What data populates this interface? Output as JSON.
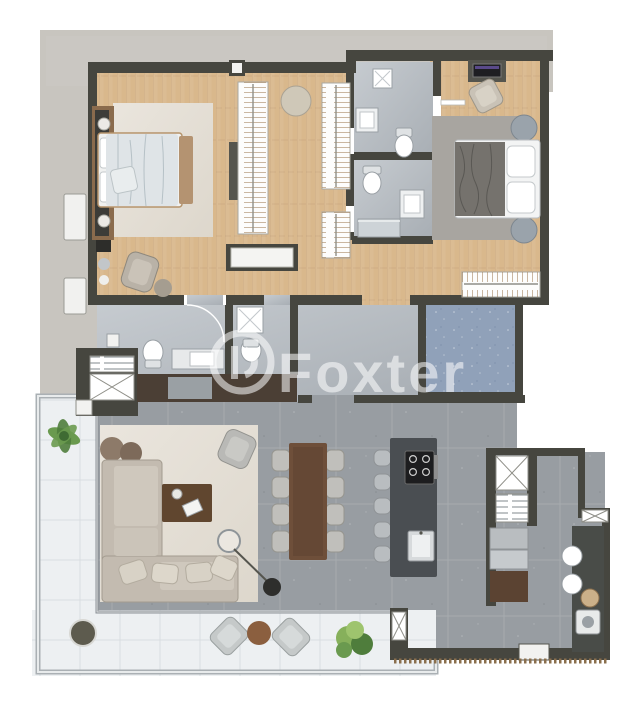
{
  "meta": {
    "type": "architectural-floor-plan-render",
    "view": "top-down 3D render",
    "visible_text": [
      "Foxter"
    ]
  },
  "watermark": {
    "text": "Foxter",
    "logo": "circle-monogram"
  },
  "colors": {
    "bg": "#ffffff",
    "slab": "#c8c5bf",
    "wall": "#46463f",
    "wood": "#d9b88c",
    "bathFloor": "#b9bec3",
    "tile": "#989da2",
    "serviceBlue": "#90a1b9",
    "balcony": "#edf0f2",
    "rugCream": "#e6e1d8",
    "rugMaster": "#dcdad2",
    "rugGray": "#a8a5a0",
    "sofa": "#c3bbb0",
    "furnWood": "#60462f",
    "island": "#4a4e52",
    "fixture": "#f6f7f7",
    "watermark": "rgba(255,255,255,0.55)",
    "green1": "#6a9a4f",
    "green2": "#4f7d3c",
    "poufBrown": "#8d7a69",
    "tableBrown": "#8b5f3f",
    "steel": "#c2c7ca",
    "dark": "#2e2e2c",
    "bedding": "#dfe4e7",
    "throwGray": "#75726d"
  },
  "rooms": [
    {
      "name": "master-bedroom",
      "floor": "wood",
      "furniture": [
        "double-bed",
        "headboard-panel",
        "rug",
        "armchair",
        "ottoman",
        "nightstand-lamps"
      ]
    },
    {
      "name": "walk-in-closet",
      "floor": "wood",
      "furniture": [
        "wardrobe-rail",
        "wardrobe-rail",
        "wardrobe-rail",
        "round-pouf",
        "bench"
      ]
    },
    {
      "name": "bathroom-1",
      "floor": "stone",
      "furniture": [
        "shower",
        "washbasin",
        "toilet"
      ]
    },
    {
      "name": "bathroom-2",
      "floor": "stone",
      "furniture": [
        "toilet",
        "vanity",
        "shower"
      ]
    },
    {
      "name": "bedroom-2",
      "floor": "wood",
      "furniture": [
        "double-bed",
        "desk",
        "monitor",
        "desk-chair",
        "rug",
        "side-tables",
        "wardrobe"
      ]
    },
    {
      "name": "powder-room-1",
      "floor": "stone",
      "furniture": [
        "toilet",
        "washbasin-counter"
      ]
    },
    {
      "name": "powder-room-2",
      "floor": "stone",
      "furniture": [
        "shower",
        "toilet"
      ]
    },
    {
      "name": "hallway",
      "floor": "tile",
      "furniture": [
        "sideboard"
      ]
    },
    {
      "name": "service-room",
      "floor": "blue-carpet",
      "furniture": []
    },
    {
      "name": "living-room",
      "floor": "tile",
      "furniture": [
        "l-sofa",
        "throw-pillows",
        "coffee-table",
        "rug",
        "poufs",
        "armchair",
        "arc-floor-lamp"
      ]
    },
    {
      "name": "dining-area",
      "floor": "tile",
      "furniture": [
        "dining-table",
        "chairs-x8"
      ]
    },
    {
      "name": "kitchen",
      "floor": "tile",
      "furniture": [
        "island",
        "cooktop",
        "sink",
        "stools-x5",
        "refrigerator-column",
        "pantry-shelves",
        "cabinet"
      ]
    },
    {
      "name": "laundry",
      "floor": "tile",
      "furniture": [
        "counter",
        "wash-basins",
        "basket",
        "washing-machine"
      ]
    },
    {
      "name": "elevator-shaft",
      "floor": null,
      "furniture": [
        "shaft-hatch"
      ]
    },
    {
      "name": "balcony",
      "floor": "light-tile",
      "furniture": [
        "palm-plant",
        "planter",
        "lounge-chairs-x2",
        "round-table",
        "shrub-plant"
      ]
    }
  ]
}
